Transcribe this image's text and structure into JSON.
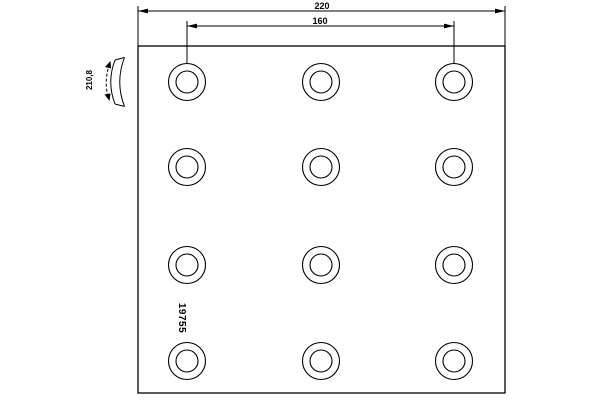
{
  "drawing": {
    "type": "technical-drawing",
    "subject": "brake lining plate with rivet holes",
    "background_color": "#ffffff",
    "line_color": "#000000",
    "dimensions": {
      "overall_width": "220",
      "hole_group_width": "160",
      "lining_radius": "210,8"
    },
    "part_number": "19755",
    "hole_grid": {
      "columns": 3,
      "rows": 4
    }
  }
}
